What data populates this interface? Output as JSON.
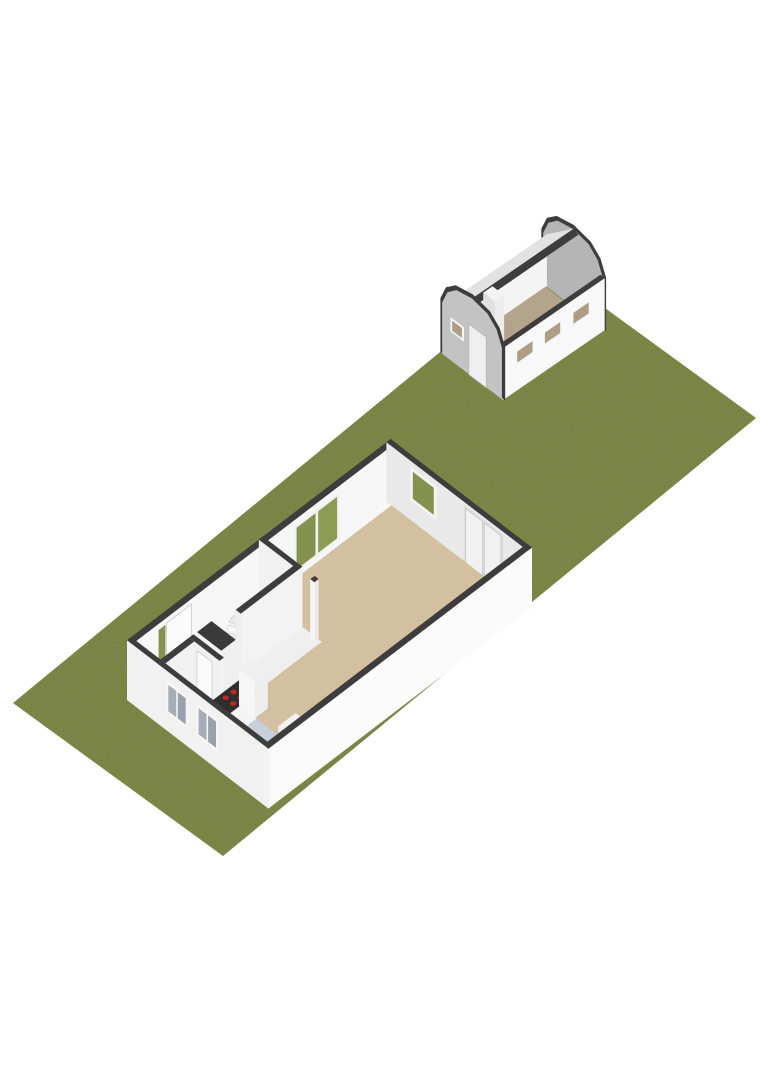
{
  "viewer": {
    "kind": "3d-floorplan-render",
    "background": "#ffffff"
  },
  "palette": {
    "grass": "#8b9751",
    "wall_cut_top": "#3d3d3d",
    "wall_white": "#f7f7f7",
    "wall_white_bright": "#fbfbfb",
    "wall_shaded": "#e9e9e9",
    "living_floor": "#d3c0a0",
    "kitchen_floor": "#c7d0da",
    "hall_floor": "#efefef",
    "door_mat": "#c19a68",
    "window_green": "#83924c",
    "window_green_light": "#8d9b55",
    "window_gray_glass": "#a7adb6",
    "counter_top": "#2e2e2e",
    "hob_burner": "#c3271f",
    "garage_gable_front": "#c3c3c3",
    "garage_gable_inner": "#b5b5b5",
    "garage_floor": "#b5a48c",
    "garage_roof_inner": "#e2e2e2",
    "garage_window_inner": "#ad9d85"
  },
  "scene": {
    "width": 768,
    "height": 1086,
    "bases": {
      "site": {
        "o": [
          13,
          703
        ],
        "u": [
          21.0,
          15.3
        ],
        "v": [
          16.656,
          -13.688
        ],
        "zs": 26
      },
      "house": {
        "o": [
          127,
          700
        ],
        "u": [
          20.2,
          15.5
        ],
        "v": [
          16.9,
          -12.9
        ],
        "zs": 26
      },
      "garage": {
        "o": [
          441,
          353
        ],
        "u": [
          19.4,
          14.7
        ],
        "v": [
          15.4,
          -10.6
        ],
        "zs": 26
      }
    },
    "elements": [
      {
        "name": "garden-plot",
        "base": "site",
        "type": "rect",
        "z": 0,
        "x0": 0,
        "x1": 10,
        "y0": 0,
        "y1": 32,
        "fill": "#8b9751",
        "grain": true
      },
      {
        "name": "garage-gable-rear-rim",
        "base": "garage",
        "type": "profiley",
        "y": 6.6,
        "pts": [
          [
            -0.07,
            0
          ],
          [
            -0.07,
            2.05
          ],
          [
            0.22,
            2.63
          ],
          [
            0.72,
            2.99
          ],
          [
            1.6,
            3.14
          ],
          [
            2.48,
            2.99
          ],
          [
            2.98,
            2.63
          ],
          [
            3.27,
            2.05
          ],
          [
            3.27,
            0
          ]
        ],
        "fill": "#3d3d3d"
      },
      {
        "name": "garage-gable-rear-inner",
        "base": "garage",
        "type": "profiley",
        "y": 6.56,
        "pts": [
          [
            0.06,
            0
          ],
          [
            0.06,
            1.98
          ],
          [
            0.33,
            2.52
          ],
          [
            0.8,
            2.87
          ],
          [
            1.6,
            3.0
          ],
          [
            2.4,
            2.87
          ],
          [
            2.87,
            2.52
          ],
          [
            3.14,
            1.98
          ],
          [
            3.14,
            0
          ]
        ],
        "fill": "#b5b5b5"
      },
      {
        "name": "garage-rear-window-slot",
        "base": "garage",
        "type": "panely",
        "y": 6.54,
        "x0": 2.35,
        "x1": 2.9,
        "z0": 0.72,
        "z1": 1.08,
        "fill": "#4a4a4a"
      },
      {
        "name": "garage-left-wall-interior",
        "base": "garage",
        "type": "panelx",
        "x": 0.22,
        "y0": 0,
        "y1": 6.6,
        "z0": 0,
        "z1": 2.0,
        "fill": "#f4f4f4"
      },
      {
        "name": "garage-roof-inner-slope",
        "base": "garage",
        "type": "poly3",
        "pts": [
          [
            0.22,
            0,
            2.0
          ],
          [
            0.22,
            6.6,
            2.0
          ],
          [
            1.6,
            6.6,
            3.0
          ],
          [
            1.6,
            0,
            3.0
          ]
        ],
        "fill": "#e2e2e2"
      },
      {
        "name": "garage-roof-ridge-cut",
        "base": "garage",
        "type": "poly3",
        "pts": [
          [
            1.6,
            0,
            3.0
          ],
          [
            1.6,
            6.6,
            3.0
          ],
          [
            1.84,
            6.6,
            2.9
          ],
          [
            1.84,
            0,
            2.9
          ]
        ],
        "fill": "#3d3d3d"
      },
      {
        "name": "garage-floor",
        "base": "garage",
        "type": "rect",
        "z": 0.02,
        "x0": 0.22,
        "x1": 2.98,
        "y0": 0.15,
        "y1": 6.5,
        "fill": "#b5a48c"
      },
      {
        "name": "garage-chimney-block",
        "base": "garage",
        "type": "box",
        "x0": 0.55,
        "x1": 1.15,
        "y0": 2.05,
        "y1": 2.65,
        "z0": 0,
        "z1": 1.8,
        "faces": {
          "px": "#ececec",
          "ny": "#e0e0e0",
          "top": "#f3f3f3"
        }
      },
      {
        "name": "garage-front-wall",
        "base": "garage",
        "type": "box",
        "x0": 2.98,
        "x1": 3.2,
        "y0": 0,
        "y1": 6.6,
        "z0": 0,
        "z1": 2.0,
        "faces": {
          "px": "#f8f8f8",
          "ny": "#f2f2f2",
          "top": "#3d3d3d"
        }
      },
      {
        "name": "garage-front-window-1-frame",
        "base": "garage",
        "type": "panelx",
        "x": 3.22,
        "y0": 0.75,
        "y1": 2.0,
        "z0": 1.0,
        "z1": 1.62,
        "fill": "#f7f7f7"
      },
      {
        "name": "garage-front-window-1-glass",
        "base": "garage",
        "type": "panelx",
        "x": 3.23,
        "y0": 0.88,
        "y1": 1.87,
        "z0": 1.1,
        "z1": 1.52,
        "fill": "#ad9d85"
      },
      {
        "name": "garage-front-window-2-frame",
        "base": "garage",
        "type": "panelx",
        "x": 3.22,
        "y0": 2.55,
        "y1": 3.8,
        "z0": 1.0,
        "z1": 1.62,
        "fill": "#f7f7f7"
      },
      {
        "name": "garage-front-window-2-glass",
        "base": "garage",
        "type": "panelx",
        "x": 3.23,
        "y0": 2.68,
        "y1": 3.67,
        "z0": 1.1,
        "z1": 1.52,
        "fill": "#ad9d85"
      },
      {
        "name": "garage-front-window-3-frame",
        "base": "garage",
        "type": "panelx",
        "x": 3.22,
        "y0": 4.4,
        "y1": 5.65,
        "z0": 1.0,
        "z1": 1.62,
        "fill": "#f7f7f7"
      },
      {
        "name": "garage-front-window-3-glass",
        "base": "garage",
        "type": "panelx",
        "x": 3.23,
        "y0": 4.53,
        "y1": 5.52,
        "z0": 1.1,
        "z1": 1.52,
        "fill": "#ad9d85"
      },
      {
        "name": "garage-gable-front-rim",
        "base": "garage",
        "type": "profiley",
        "y": 0.05,
        "pts": [
          [
            -0.07,
            0
          ],
          [
            -0.07,
            2.05
          ],
          [
            0.22,
            2.63
          ],
          [
            0.72,
            2.99
          ],
          [
            1.6,
            3.14
          ],
          [
            2.48,
            2.99
          ],
          [
            2.98,
            2.63
          ],
          [
            3.27,
            2.05
          ],
          [
            3.27,
            0
          ]
        ],
        "fill": "#3d3d3d"
      },
      {
        "name": "garage-gable-front",
        "base": "garage",
        "type": "profiley",
        "y": 0,
        "pts": [
          [
            0.06,
            0
          ],
          [
            0.06,
            1.98
          ],
          [
            0.33,
            2.52
          ],
          [
            0.8,
            2.87
          ],
          [
            1.6,
            3.0
          ],
          [
            2.4,
            2.87
          ],
          [
            2.87,
            2.52
          ],
          [
            3.14,
            1.98
          ],
          [
            3.14,
            0
          ]
        ],
        "fill": "#c3c3c3"
      },
      {
        "name": "garage-door",
        "base": "garage",
        "type": "panely",
        "y": -0.02,
        "x0": 1.45,
        "x1": 2.35,
        "z0": 0,
        "z1": 1.95,
        "fill": "#efefef",
        "stroke": "#b5b5b5"
      },
      {
        "name": "garage-gable-window-frame",
        "base": "garage",
        "type": "panely",
        "y": -0.02,
        "x0": 0.5,
        "x1": 1.2,
        "z0": 1.12,
        "z1": 1.68,
        "fill": "#f5f5f5"
      },
      {
        "name": "garage-gable-window-glass",
        "base": "garage",
        "type": "panely",
        "y": -0.03,
        "x0": 0.6,
        "x1": 1.1,
        "z0": 1.21,
        "z1": 1.59,
        "fill": "#ad9d85"
      },
      {
        "name": "house-wall-nw",
        "base": "house",
        "type": "box",
        "x0": 0,
        "x1": 0.25,
        "y0": 0,
        "y1": 15.6,
        "z0": 0,
        "z1": 2.3,
        "faces": {
          "px": "#f7f7f7",
          "ny": "#ededed",
          "top": "#3d3d3d"
        }
      },
      {
        "name": "front-door-sidelight-glass",
        "base": "house",
        "type": "panelx",
        "x": 0.27,
        "y0": 1.55,
        "y1": 1.95,
        "z0": 0.08,
        "z1": 2.08,
        "fill": "#83924c"
      },
      {
        "name": "front-door",
        "base": "house",
        "type": "panelx",
        "x": 0.27,
        "y0": 2.0,
        "y1": 3.5,
        "z0": 0,
        "z1": 2.12,
        "fill": "#fbfbfb",
        "stroke": "#c9c9c9"
      },
      {
        "name": "nw-sliding-window-frame",
        "base": "house",
        "type": "panelx",
        "x": 0.27,
        "y0": 9.55,
        "y1": 12.25,
        "z0": 0.25,
        "z1": 2.1,
        "fill": "#f2f2f2"
      },
      {
        "name": "nw-sliding-window-glass-left",
        "base": "house",
        "type": "panelx",
        "x": 0.28,
        "y0": 9.7,
        "y1": 10.82,
        "z0": 0.38,
        "z1": 1.98,
        "fill": "#83924c"
      },
      {
        "name": "nw-sliding-window-glass-right",
        "base": "house",
        "type": "panelx",
        "x": 0.28,
        "y0": 10.98,
        "y1": 12.1,
        "z0": 0.38,
        "z1": 1.98,
        "fill": "#8d9b55"
      },
      {
        "name": "house-wall-ne",
        "base": "house",
        "type": "box",
        "x0": 0,
        "x1": 7.0,
        "y0": 15.35,
        "y1": 15.6,
        "z0": 0,
        "z1": 2.3,
        "faces": {
          "ny": "#e9e9e9",
          "top": "#3d3d3d"
        }
      },
      {
        "name": "ne-window-frame",
        "base": "house",
        "type": "panely",
        "y": 15.33,
        "x0": 1.2,
        "x1": 2.5,
        "z0": 0.8,
        "z1": 2.1,
        "fill": "#f4f4f4"
      },
      {
        "name": "ne-window-glass",
        "base": "house",
        "type": "panely",
        "y": 15.32,
        "x0": 1.33,
        "x1": 2.37,
        "z0": 0.93,
        "z1": 1.97,
        "fill": "#83924c"
      },
      {
        "name": "ne-patio-doors-frame",
        "base": "house",
        "type": "panely",
        "y": 15.33,
        "x0": 3.85,
        "x1": 5.8,
        "z0": 0,
        "z1": 2.2,
        "fill": "#dedede"
      },
      {
        "name": "ne-patio-door-left",
        "base": "house",
        "type": "panely",
        "y": 15.32,
        "x0": 3.95,
        "x1": 4.78,
        "z0": 0,
        "z1": 2.12,
        "fill": "#f1f1f1",
        "stroke": "#c6c6c6"
      },
      {
        "name": "ne-patio-door-right",
        "base": "house",
        "type": "panely",
        "y": 15.32,
        "x0": 4.87,
        "x1": 5.7,
        "z0": 0,
        "z1": 2.12,
        "fill": "#f1f1f1",
        "stroke": "#c6c6c6"
      },
      {
        "name": "living-room-floor",
        "base": "house",
        "type": "rect",
        "z": 0.02,
        "x0": 0.25,
        "x1": 6.75,
        "y0": 0.25,
        "y1": 15.35,
        "fill": "#d3c0a0"
      },
      {
        "name": "kitchen-floor",
        "base": "house",
        "type": "rect",
        "z": 0.03,
        "x0": 2.95,
        "x1": 6.75,
        "y0": 0.25,
        "y1": 3.1,
        "fill": "#c7d0da"
      },
      {
        "name": "hall-floor",
        "base": "house",
        "type": "rect",
        "z": 0.03,
        "x0": 0.25,
        "x1": 2.95,
        "y0": 0.25,
        "y1": 8.0,
        "fill": "#efefef"
      },
      {
        "name": "entrance-door-mat",
        "base": "house",
        "type": "rect",
        "z": 0.04,
        "x0": 0.3,
        "x1": 1.45,
        "y0": 1.9,
        "y1": 3.5,
        "fill": "#c19a68"
      },
      {
        "name": "hall-partition-wall",
        "base": "house",
        "type": "box",
        "x0": 0,
        "x1": 1.95,
        "y0": 7.8,
        "y1": 8.05,
        "z0": 0,
        "z1": 2.3,
        "faces": {
          "ny": "#f1f1f1",
          "px": "#ededed",
          "top": "#3d3d3d"
        }
      },
      {
        "name": "hall-doorway-post",
        "base": "house",
        "type": "box",
        "x0": 2.55,
        "x1": 2.75,
        "y0": 7.8,
        "y1": 8.05,
        "z0": 0,
        "z1": 2.3,
        "faces": {
          "nx": "#f5f5f5",
          "ny": "#f5f5f5",
          "px": "#eaeaea",
          "top": "#3d3d3d"
        }
      },
      {
        "name": "winder-staircase",
        "base": "house",
        "type": "stairs",
        "pivot": [
          1.66,
          6.08
        ],
        "r": 1.4,
        "a0": 252,
        "a1": 94,
        "n": 9,
        "z0": 0.08,
        "dz": 0.115,
        "fills": [
          "#f7f7f7",
          "#e8e8e8"
        ],
        "stroke": "#d6d6d6"
      },
      {
        "name": "staircase-side-wall",
        "base": "house",
        "type": "box",
        "x0": 1.7,
        "x1": 1.95,
        "y0": 4.4,
        "y1": 8.05,
        "z0": 0,
        "z1": 2.3,
        "faces": {
          "ny": "#efefef",
          "px": "#f3f3f3",
          "top": "#3d3d3d"
        }
      },
      {
        "name": "understairs-cupboard",
        "base": "house",
        "type": "box",
        "x0": 0.5,
        "x1": 1.7,
        "y0": 3.55,
        "y1": 4.4,
        "z0": 0,
        "z1": 1.15,
        "faces": {
          "ny": "#f6f6f6",
          "px": "#efefef",
          "top": "#3a3a3a"
        }
      },
      {
        "name": "toilet-wall-kitchen-side",
        "base": "house",
        "type": "box",
        "x0": 2.7,
        "x1": 2.95,
        "y0": 0.25,
        "y1": 2.2,
        "z0": 0,
        "z1": 2.3,
        "faces": {
          "ny": "#ededed",
          "px": "#f2f2f2",
          "top": "#3d3d3d"
        }
      },
      {
        "name": "toilet-wall-hall-side",
        "base": "house",
        "type": "box",
        "x0": 1.45,
        "x1": 2.95,
        "y0": 1.95,
        "y1": 2.2,
        "z0": 0,
        "z1": 2.3,
        "faces": {
          "ny": "#f0f0f0",
          "nx": "#ececec",
          "top": "#3d3d3d"
        }
      },
      {
        "name": "toilet-door",
        "base": "house",
        "type": "panely",
        "y": 1.93,
        "x0": 1.85,
        "x1": 2.6,
        "z0": 0,
        "z1": 2.05,
        "fill": "#fafafa",
        "stroke": "#cccccc"
      },
      {
        "name": "toilet-wall-corridor-side",
        "base": "house",
        "type": "box",
        "x0": 1.45,
        "x1": 1.7,
        "y0": 0.25,
        "y1": 1.95,
        "z0": 0,
        "z1": 2.3,
        "faces": {
          "ny": "#eeeeee",
          "px": "#f1f1f1",
          "top": "#3d3d3d"
        }
      },
      {
        "name": "toilet-bowl",
        "base": "house",
        "type": "box",
        "x0": 1.95,
        "x1": 2.3,
        "y0": 0.5,
        "y1": 0.95,
        "z0": 0,
        "z1": 0.4,
        "faces": {
          "px": "#f0f2f4",
          "ny": "#e6e8ea",
          "top": "#fafafa"
        }
      },
      {
        "name": "kitchen-counter",
        "base": "house",
        "type": "box",
        "x0": 2.95,
        "x1": 3.8,
        "y0": 0.25,
        "y1": 3.1,
        "z0": 0,
        "z1": 0.98,
        "faces": {
          "px": "#f4f4f4",
          "ny": "#e8e8e8",
          "top": "#2e2e2e"
        }
      },
      {
        "name": "hob-burners",
        "base": "house",
        "type": "dots",
        "z": 0.99,
        "r": 3.2,
        "fill": "#c3271f",
        "pts": [
          [
            3.2,
            2.02
          ],
          [
            3.57,
            2.02
          ],
          [
            3.2,
            2.48
          ],
          [
            3.57,
            2.48
          ]
        ]
      },
      {
        "name": "kitchen-tall-cabinet",
        "base": "house",
        "type": "box",
        "x0": 2.95,
        "x1": 3.75,
        "y0": 3.1,
        "y1": 3.85,
        "z0": 0,
        "z1": 1.4,
        "faces": {
          "ny": "#f6f6f6",
          "px": "#eeeeee",
          "top": "#f0f0f0"
        }
      },
      {
        "name": "kitchen-island-unit",
        "base": "house",
        "type": "box",
        "x0": 5.3,
        "x1": 6.7,
        "y0": 2.6,
        "y1": 3.65,
        "z0": 0,
        "z1": 0.85,
        "faces": {
          "ny": "#e9e9e9",
          "nx": "#ececec",
          "px": "#f7f7f7",
          "top": "#f1f1f1"
        }
      },
      {
        "name": "house-wall-se",
        "base": "house",
        "type": "box",
        "x0": 6.75,
        "x1": 7.0,
        "y0": 0,
        "y1": 15.6,
        "z0": 0,
        "z1": 2.3,
        "faces": {
          "px": "#fbfbfb",
          "ny": "#f5f5f5",
          "top": "#3d3d3d"
        }
      },
      {
        "name": "house-wall-sw",
        "base": "house",
        "type": "box",
        "x0": 0,
        "x1": 7.0,
        "y0": 0,
        "y1": 0.25,
        "z0": 0,
        "z1": 2.3,
        "faces": {
          "ny": "#f1f1f1",
          "px": "#f8f8f8",
          "top": "#3d3d3d"
        }
      },
      {
        "name": "sw-window-1-frame",
        "base": "house",
        "type": "panely",
        "y": -0.02,
        "x0": 1.95,
        "x1": 3.05,
        "z0": 0.7,
        "z1": 1.95,
        "fill": "#f6f6f6"
      },
      {
        "name": "sw-window-1-glass-left",
        "base": "house",
        "type": "panely",
        "y": -0.03,
        "x0": 2.07,
        "x1": 2.46,
        "z0": 0.82,
        "z1": 1.83,
        "fill": "#a7adb6"
      },
      {
        "name": "sw-window-1-glass-right",
        "base": "house",
        "type": "panely",
        "y": -0.03,
        "x0": 2.54,
        "x1": 2.93,
        "z0": 0.82,
        "z1": 1.83,
        "fill": "#9aa1ab"
      },
      {
        "name": "sw-window-2-frame",
        "base": "house",
        "type": "panely",
        "y": -0.02,
        "x0": 3.45,
        "x1": 4.55,
        "z0": 0.7,
        "z1": 1.95,
        "fill": "#f6f6f6"
      },
      {
        "name": "sw-window-2-glass-left",
        "base": "house",
        "type": "panely",
        "y": -0.03,
        "x0": 3.57,
        "x1": 3.96,
        "z0": 0.82,
        "z1": 1.83,
        "fill": "#a7adb6"
      },
      {
        "name": "sw-window-2-glass-right",
        "base": "house",
        "type": "panely",
        "y": -0.03,
        "x0": 4.04,
        "x1": 4.43,
        "z0": 0.82,
        "z1": 1.83,
        "fill": "#9aa1ab"
      }
    ]
  }
}
